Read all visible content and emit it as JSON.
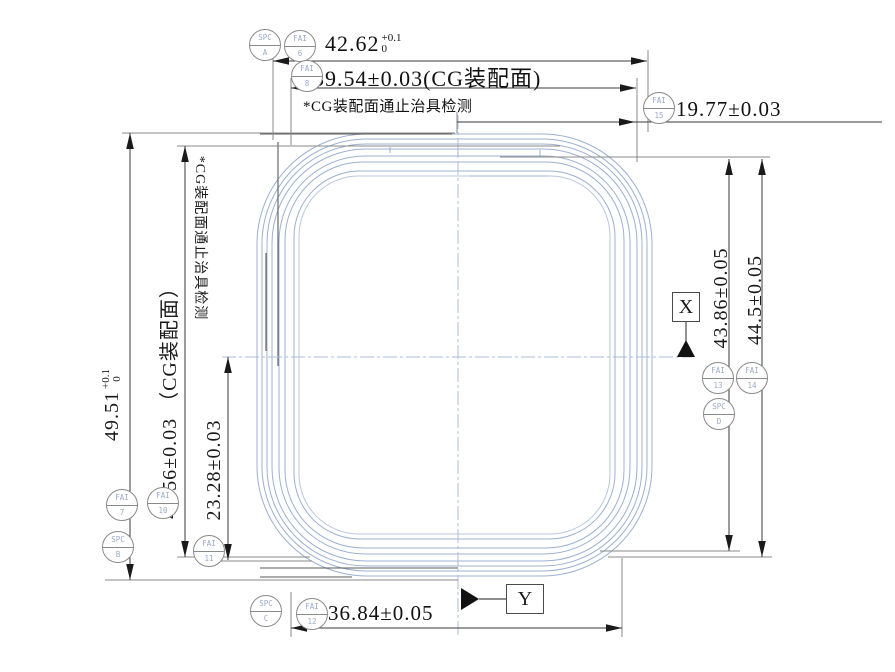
{
  "drawing": {
    "dims": {
      "top_width": {
        "value": "42.62",
        "tol_up": "+0.1",
        "tol_dn": "0"
      },
      "cg_width": "39.54±0.03(CG装配面)",
      "top_note": "*CG装配面通止治具检测",
      "right_offset": "19.77±0.03",
      "left_height": {
        "value": "49.51",
        "tol_up": "+0.1",
        "tol_dn": "0"
      },
      "cg_height": "46.56±0.03 （CG装配面）",
      "left_note": "*CG装配面通止治具检测",
      "half_height": "23.28±0.03",
      "right_height_inner": "43.86±0.05",
      "right_height_outer": "44.5±0.05",
      "bottom_width": "36.84±0.05"
    },
    "datums": {
      "x": "X",
      "y": "Y"
    },
    "balloons": [
      {
        "type": "SPC",
        "id": "A"
      },
      {
        "type": "FAI",
        "id": "6"
      },
      {
        "type": "FAI",
        "id": "8"
      },
      {
        "type": "FAI",
        "id": "15"
      },
      {
        "type": "FAI",
        "id": "7"
      },
      {
        "type": "SPC",
        "id": "B"
      },
      {
        "type": "FAI",
        "id": "10"
      },
      {
        "type": "FAI",
        "id": "11"
      },
      {
        "type": "SPC",
        "id": "C"
      },
      {
        "type": "FAI",
        "id": "12"
      },
      {
        "type": "FAI",
        "id": "13"
      },
      {
        "type": "FAI",
        "id": "14"
      },
      {
        "type": "SPC",
        "id": "D"
      }
    ],
    "colors": {
      "outline": "#9cb0d2",
      "outline_dark": "#5a5a5a",
      "dimension": "#3a3a3a",
      "extension": "#8a8a8a",
      "centerline": "#a9bdd9",
      "balloon_text": "#9aaac8"
    }
  }
}
